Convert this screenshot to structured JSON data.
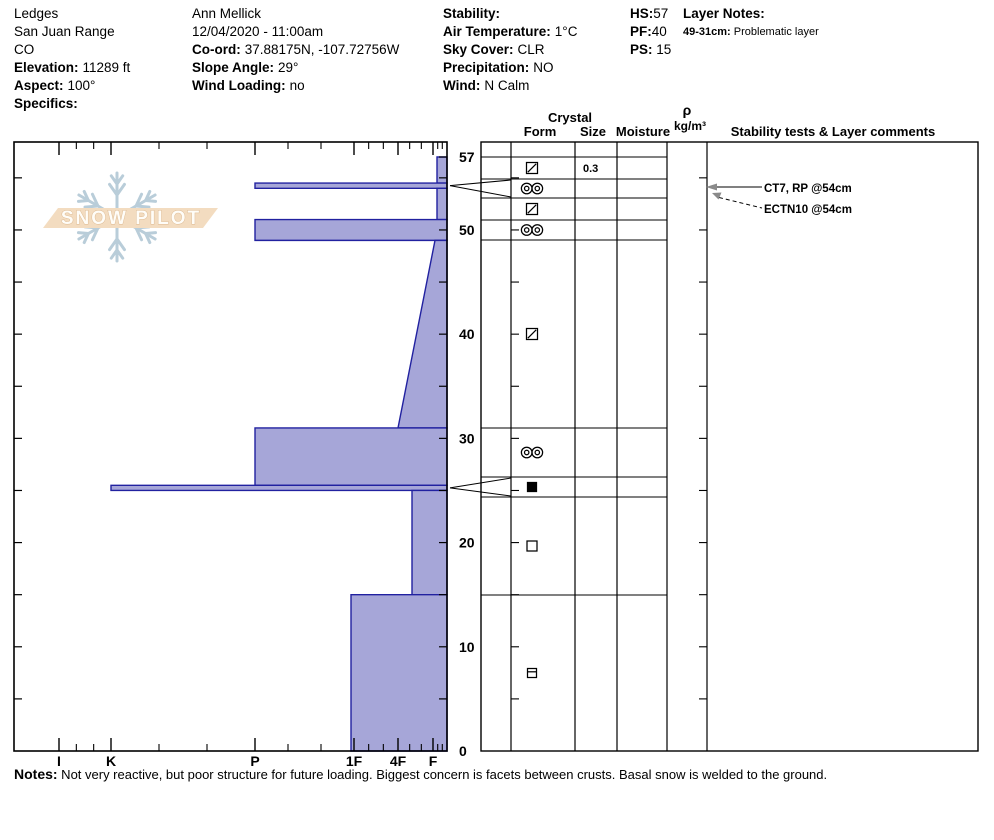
{
  "header": {
    "site": {
      "name": "Ledges",
      "region": "San Juan Range",
      "state": "CO",
      "elevation_label": "Elevation:",
      "elevation": "11289 ft",
      "aspect_label": "Aspect:",
      "aspect": "100°",
      "specifics_label": "Specifics:"
    },
    "observer": {
      "name": "Ann Mellick",
      "datetime": "12/04/2020 - 11:00am",
      "coord_label": "Co-ord:",
      "coord": "37.88175N, -107.72756W",
      "slope_label": "Slope Angle:",
      "slope": "29°",
      "wind_loading_label": "Wind Loading:",
      "wind_loading": "no"
    },
    "conditions": {
      "stability_label": "Stability:",
      "air_temp_label": "Air Temperature:",
      "air_temp": "1°C",
      "sky_label": "Sky Cover:",
      "sky": "CLR",
      "precip_label": "Precipitation:",
      "precip": "NO",
      "wind_label": "Wind:",
      "wind": "N Calm"
    },
    "snowpack": {
      "hs_label": "HS:",
      "hs": "57",
      "pf_label": "PF:",
      "pf": "40",
      "ps_label": "PS: ",
      "ps": "15"
    },
    "layer_notes": {
      "title": "Layer Notes:",
      "entry_label": "49-31cm:",
      "entry": " Problematic layer"
    }
  },
  "logo": {
    "text": "SNOW PILOT"
  },
  "notes": {
    "label": "Notes:",
    "text": " Not very reactive, but poor structure for future loading. Biggest concern is facets between crusts. Basal snow is welded to the ground."
  },
  "chart_data": {
    "type": "bar",
    "subtype": "snow-profile-hardness-vs-depth",
    "depth_axis": {
      "unit": "cm",
      "min": 0,
      "max": 57,
      "tick_labels": [
        57,
        50,
        40,
        30,
        20,
        10,
        0
      ],
      "minor_tick_step_cm": 5
    },
    "hardness_axis": {
      "categories": [
        "I",
        "K",
        "P",
        "1F",
        "4F",
        "F"
      ],
      "positions_px": [
        59,
        111,
        255,
        354,
        398,
        433
      ],
      "extra_minor_px": [
        437.7,
        442.3
      ]
    },
    "layers": [
      {
        "top_cm": 57,
        "bottom_cm": 54.5,
        "hardness": "F",
        "x_px": 437,
        "grain_form": "square-slash",
        "size_mm": "0.3"
      },
      {
        "top_cm": 54.5,
        "bottom_cm": 54,
        "hardness": "P",
        "x_px": 255,
        "grain_form": "double-circle",
        "thin_layer_pointer": true
      },
      {
        "top_cm": 54,
        "bottom_cm": 51,
        "hardness": "F",
        "x_px": 437,
        "grain_form": "square-slash"
      },
      {
        "top_cm": 51,
        "bottom_cm": 49,
        "hardness": "P",
        "x_px": 255,
        "grain_form": "double-circle"
      },
      {
        "top_cm": 49,
        "bottom_cm": 31,
        "hardness": "F grading to 4F",
        "x_top_px": 435,
        "x_bottom_px": 398,
        "grain_form": "square-slash"
      },
      {
        "top_cm": 31,
        "bottom_cm": 25.5,
        "hardness": "P",
        "x_px": 255,
        "grain_form": "double-circle"
      },
      {
        "top_cm": 25.5,
        "bottom_cm": 25,
        "hardness": "K",
        "x_px": 111,
        "grain_form": "filled-square",
        "thin_layer_pointer": true
      },
      {
        "top_cm": 25,
        "bottom_cm": 15,
        "hardness": "4F+",
        "x_px": 412,
        "grain_form": "open-square"
      },
      {
        "top_cm": 15,
        "bottom_cm": 0,
        "hardness": "1F",
        "x_px": 351,
        "grain_form": "square-hbar"
      }
    ],
    "table": {
      "header_crystal": "Crystal",
      "header_form": "Form",
      "header_size": "Size",
      "header_moisture": "Moisture",
      "header_rho": "ρ",
      "header_rho_unit": "kg/m³",
      "header_comments": "Stability tests & Layer comments",
      "row_lines_px": [
        157,
        179,
        198,
        220,
        240,
        428,
        477,
        497,
        595,
        751
      ]
    },
    "annotations": [
      {
        "text": "CT7, RP @54cm",
        "depth_cm": 54,
        "arrow": "solid-horizontal"
      },
      {
        "text": "ECTN10 @54cm",
        "depth_cm": 54,
        "arrow": "dashed-diagonal"
      }
    ],
    "colors": {
      "bar_fill": "#a6a6d8",
      "bar_stroke": "#2121a0",
      "axis": "#000000",
      "arrowhead": "#8a8a8a",
      "logo_flake": "#b9cdd9",
      "logo_banner": "#f3dcc0",
      "logo_text_fill": "#fffdf8",
      "logo_text_outline": "#dcb991"
    },
    "layout": {
      "chart_box": {
        "left": 14,
        "top": 142,
        "right": 447,
        "bottom": 751,
        "surface_y": 157
      },
      "table_cols_px": [
        481,
        511,
        575,
        617,
        667,
        707,
        978
      ],
      "form_symbol_x": 532,
      "size_text_x": 583,
      "depth_label_x": 459,
      "annotation_text_x": 764,
      "legend_position": "none",
      "grid": "off"
    }
  }
}
